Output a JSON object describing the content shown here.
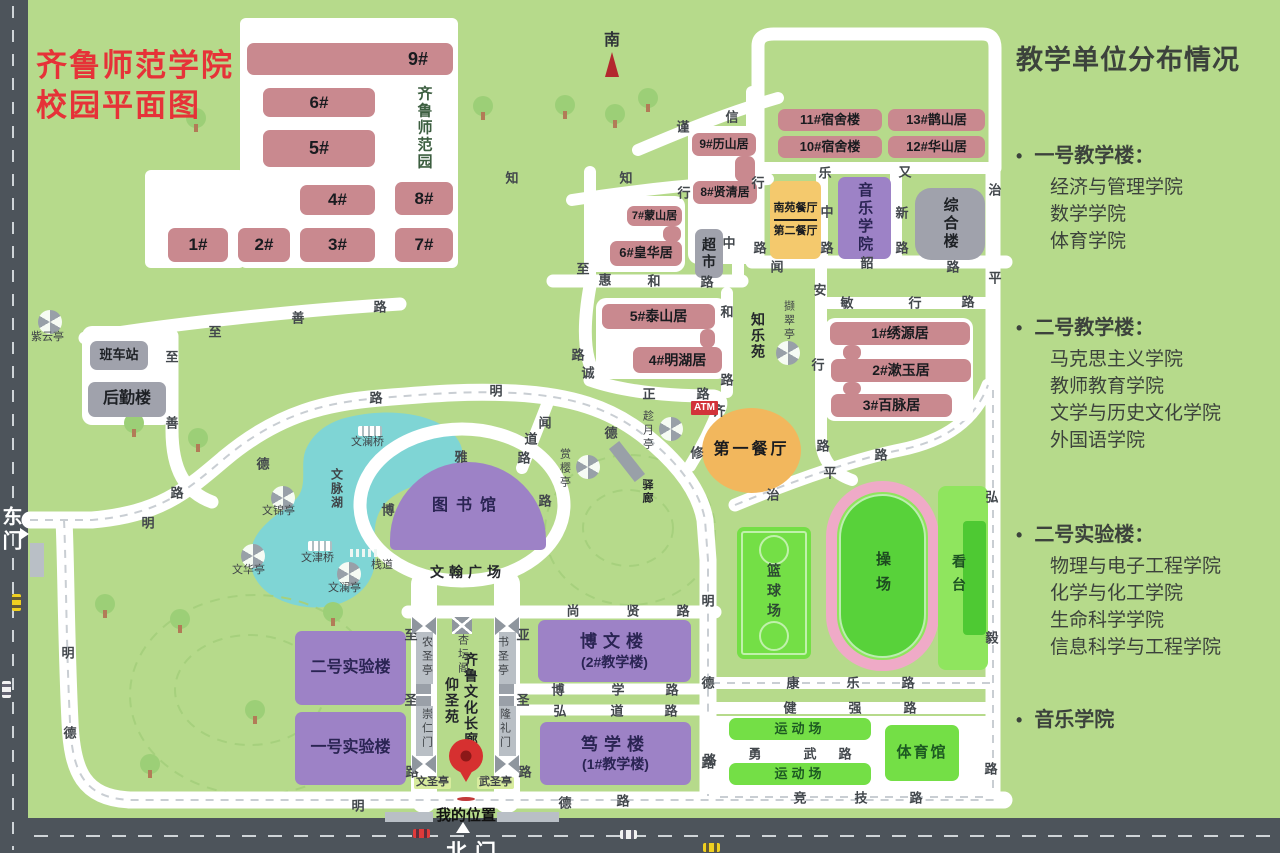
{
  "title": {
    "line1": "齐鲁师范学院",
    "line2": "校园平面图"
  },
  "compass_label": "南",
  "gates": {
    "east": "东门",
    "north": "北门"
  },
  "my_location_label": "我的位置",
  "atm_label": "ATM",
  "sidebar": {
    "title": "教学单位分布情况",
    "sections": [
      {
        "heading": "一号教学楼：",
        "items": [
          "经济与管理学院",
          "数学学院",
          "体育学院"
        ],
        "gap": 0
      },
      {
        "heading": "二号教学楼：",
        "items": [
          "马克思主义学院",
          "教师教育学院",
          "文学与历史文化学院",
          "外国语学院"
        ],
        "gap": 56
      },
      {
        "heading": "二号实验楼：",
        "items": [
          "物理与电子工程学院",
          "化学与化工学院",
          "生命科学学院",
          "信息科学与工程学院"
        ],
        "gap": 64
      },
      {
        "heading": "音乐学院",
        "items": [],
        "gap": 42
      }
    ]
  },
  "plates": [
    {
      "x": 240,
      "y": 18,
      "w": 218,
      "h": 250,
      "r": 6
    },
    {
      "x": 145,
      "y": 170,
      "w": 100,
      "h": 98,
      "r": 6
    },
    {
      "x": 82,
      "y": 326,
      "w": 90,
      "h": 99,
      "r": 10
    },
    {
      "x": 688,
      "y": 126,
      "w": 70,
      "h": 138,
      "r": 10
    },
    {
      "x": 585,
      "y": 196,
      "w": 100,
      "h": 76,
      "r": 10
    },
    {
      "x": 596,
      "y": 298,
      "w": 131,
      "h": 81,
      "r": 10
    },
    {
      "x": 825,
      "y": 318,
      "w": 148,
      "h": 103,
      "r": 10
    },
    {
      "x": 702,
      "y": 716,
      "w": 290,
      "h": 78,
      "r": 6
    }
  ],
  "buildings": [
    {
      "id": "9",
      "label": "9#",
      "type": "pink",
      "x": 247,
      "y": 43,
      "w": 206,
      "h": 32,
      "fs": 18,
      "alignRight": true
    },
    {
      "id": "6",
      "label": "6#",
      "type": "pink",
      "x": 263,
      "y": 88,
      "w": 112,
      "h": 29,
      "fs": 17
    },
    {
      "id": "5",
      "label": "5#",
      "type": "pink",
      "x": 263,
      "y": 130,
      "w": 112,
      "h": 37,
      "fs": 18
    },
    {
      "id": "4",
      "label": "4#",
      "type": "pink",
      "x": 300,
      "y": 185,
      "w": 75,
      "h": 30,
      "fs": 17
    },
    {
      "id": "8",
      "label": "8#",
      "type": "pink",
      "x": 395,
      "y": 182,
      "w": 58,
      "h": 33,
      "fs": 17
    },
    {
      "id": "1",
      "label": "1#",
      "type": "pink",
      "x": 168,
      "y": 228,
      "w": 60,
      "h": 34,
      "fs": 17
    },
    {
      "id": "2",
      "label": "2#",
      "type": "pink",
      "x": 238,
      "y": 228,
      "w": 52,
      "h": 34,
      "fs": 17
    },
    {
      "id": "3",
      "label": "3#",
      "type": "pink",
      "x": 300,
      "y": 228,
      "w": 75,
      "h": 34,
      "fs": 17
    },
    {
      "id": "7",
      "label": "7#",
      "type": "pink",
      "x": 395,
      "y": 228,
      "w": 58,
      "h": 34,
      "fs": 17
    },
    {
      "id": "dorm11",
      "label": "11#宿舍楼",
      "type": "pink",
      "x": 778,
      "y": 109,
      "w": 104,
      "h": 22,
      "fs": 13
    },
    {
      "id": "dorm13",
      "label": "13#鹊山居",
      "type": "pink",
      "x": 888,
      "y": 109,
      "w": 97,
      "h": 22,
      "fs": 13
    },
    {
      "id": "dorm10",
      "label": "10#宿舍楼",
      "type": "pink",
      "x": 778,
      "y": 136,
      "w": 104,
      "h": 22,
      "fs": 13
    },
    {
      "id": "dorm12",
      "label": "12#华山居",
      "type": "pink",
      "x": 888,
      "y": 136,
      "w": 97,
      "h": 22,
      "fs": 13
    },
    {
      "id": "dorm9",
      "label": "9#历山居",
      "type": "pink",
      "x": 692,
      "y": 133,
      "w": 64,
      "h": 23,
      "fs": 12
    },
    {
      "id": "dorm8",
      "label": "8#贤清居",
      "type": "pink",
      "x": 693,
      "y": 181,
      "w": 64,
      "h": 23,
      "fs": 12
    },
    {
      "id": "dorm7",
      "label": "7#蒙山居",
      "type": "pink",
      "x": 627,
      "y": 206,
      "w": 55,
      "h": 20,
      "fs": 11
    },
    {
      "id": "dorm6",
      "label": "6#皇华居",
      "type": "pink",
      "x": 610,
      "y": 241,
      "w": 72,
      "h": 25,
      "fs": 13
    },
    {
      "id": "dorm5",
      "label": "5#泰山居",
      "type": "pink",
      "x": 602,
      "y": 304,
      "w": 113,
      "h": 25,
      "fs": 14
    },
    {
      "id": "dorm4",
      "label": "4#明湖居",
      "type": "pink",
      "x": 633,
      "y": 347,
      "w": 89,
      "h": 26,
      "fs": 14
    },
    {
      "id": "dorm1",
      "label": "1#绣源居",
      "type": "pink",
      "x": 830,
      "y": 322,
      "w": 140,
      "h": 23,
      "fs": 14
    },
    {
      "id": "dorm2",
      "label": "2#漱玉居",
      "type": "pink",
      "x": 831,
      "y": 359,
      "w": 140,
      "h": 23,
      "fs": 14
    },
    {
      "id": "dorm3",
      "label": "3#百脉居",
      "type": "pink",
      "x": 831,
      "y": 394,
      "w": 121,
      "h": 23,
      "fs": 14
    },
    {
      "id": "conn1",
      "label": "",
      "type": "pink",
      "x": 735,
      "y": 156,
      "w": 20,
      "h": 26
    },
    {
      "id": "conn2",
      "label": "",
      "type": "pink",
      "x": 663,
      "y": 226,
      "w": 18,
      "h": 16
    },
    {
      "id": "conn3",
      "label": "",
      "type": "pink",
      "x": 700,
      "y": 329,
      "w": 15,
      "h": 19
    },
    {
      "id": "conn4",
      "label": "",
      "type": "pink",
      "x": 843,
      "y": 345,
      "w": 18,
      "h": 15
    },
    {
      "id": "conn5",
      "label": "",
      "type": "pink",
      "x": 843,
      "y": 382,
      "w": 18,
      "h": 13
    },
    {
      "id": "music",
      "label": "音乐学院",
      "type": "purple",
      "x": 838,
      "y": 177,
      "w": 53,
      "h": 82,
      "fs": 15,
      "vert": true
    },
    {
      "id": "zonghelou",
      "label": "综合楼",
      "type": "grayb",
      "x": 915,
      "y": 188,
      "w": 70,
      "h": 72,
      "fs": 15,
      "vert": true,
      "r": 16
    },
    {
      "id": "bowenlou",
      "label": "博文楼",
      "sub": "(2#教学楼)",
      "type": "purple",
      "x": 538,
      "y": 620,
      "w": 153,
      "h": 62,
      "fs": 17,
      "ls": 6
    },
    {
      "id": "duxuelou",
      "label": "笃学楼",
      "sub": "(1#教学楼)",
      "type": "purple",
      "x": 540,
      "y": 722,
      "w": 151,
      "h": 63,
      "fs": 17,
      "ls": 6
    },
    {
      "id": "lab2",
      "label": "二号实验楼",
      "type": "purple",
      "x": 295,
      "y": 631,
      "w": 111,
      "h": 74,
      "fs": 16
    },
    {
      "id": "lab1",
      "label": "一号实验楼",
      "type": "purple",
      "x": 295,
      "y": 712,
      "w": 111,
      "h": 73,
      "fs": 16
    },
    {
      "id": "library",
      "label": "图书馆",
      "type": "dome",
      "x": 390,
      "y": 462,
      "w": 156,
      "h": 88,
      "fs": 16,
      "ls": 8
    },
    {
      "id": "banchezhan",
      "label": "班车站",
      "type": "grayb",
      "x": 90,
      "y": 341,
      "w": 58,
      "h": 29,
      "fs": 13
    },
    {
      "id": "houqinlou",
      "label": "后勤楼",
      "type": "grayb",
      "x": 88,
      "y": 382,
      "w": 78,
      "h": 35,
      "fs": 16
    },
    {
      "id": "chaoshi",
      "label": "超市",
      "type": "grayb",
      "x": 695,
      "y": 229,
      "w": 28,
      "h": 49,
      "fs": 14,
      "vert": true
    },
    {
      "id": "canteen2",
      "label": "南苑餐厅",
      "sub2": "第二餐厅",
      "type": "split",
      "x": 770,
      "y": 181,
      "w": 51,
      "h": 78,
      "fs": 11
    },
    {
      "id": "canteen1",
      "label": "第一餐厅",
      "type": "orangeb",
      "x": 702,
      "y": 408,
      "w": 99,
      "h": 85,
      "fs": 16,
      "ls": 3
    },
    {
      "id": "basketball",
      "label": "篮球场",
      "type": "court",
      "x": 737,
      "y": 527,
      "w": 74,
      "h": 132,
      "fs": 14
    },
    {
      "id": "playground",
      "label": "操场",
      "type": "track",
      "x": 826,
      "y": 481,
      "w": 113,
      "h": 190
    },
    {
      "id": "stand",
      "label": "看台",
      "type": "stand",
      "x": 938,
      "y": 486,
      "w": 50,
      "h": 184
    },
    {
      "id": "sportsfield1",
      "label": "运动场",
      "type": "bgreen",
      "x": 729,
      "y": 718,
      "w": 142,
      "h": 22,
      "fs": 13,
      "ls": 4
    },
    {
      "id": "sportsfield2",
      "label": "运动场",
      "type": "bgreen",
      "x": 729,
      "y": 763,
      "w": 142,
      "h": 22,
      "fs": 13,
      "ls": 4
    },
    {
      "id": "gym",
      "label": "体育馆",
      "type": "bgreen",
      "x": 885,
      "y": 725,
      "w": 74,
      "h": 56,
      "fs": 15,
      "ls": 2
    }
  ],
  "area_labels": [
    {
      "t": "齐鲁师范园",
      "x": 424,
      "y": 128,
      "vert": true,
      "fs": 15,
      "color": "#3c5e40"
    },
    {
      "t": "知乐苑",
      "x": 758,
      "y": 336,
      "vert": true,
      "fs": 14
    },
    {
      "t": "文脉湖",
      "x": 337,
      "y": 489,
      "vert": true,
      "fs": 12,
      "color": "#3f4347"
    },
    {
      "t": "文翰广场",
      "x": 468,
      "y": 572,
      "vert": false,
      "fs": 14,
      "ls": 5
    },
    {
      "t": "仰圣苑",
      "x": 452,
      "y": 701,
      "vert": true,
      "fs": 14
    },
    {
      "t": "齐鲁文化长廊",
      "x": 471,
      "y": 700,
      "vert": true,
      "fs": 14
    },
    {
      "t": "驿廊",
      "x": 647,
      "y": 492,
      "vert": true,
      "fs": 11
    }
  ],
  "road_labels": [
    [
      "至",
      215,
      331
    ],
    [
      "善",
      298,
      317
    ],
    [
      "路",
      380,
      306
    ],
    [
      "至",
      172,
      356
    ],
    [
      "善",
      172,
      422
    ],
    [
      "路",
      177,
      492
    ],
    [
      "明",
      148,
      522
    ],
    [
      "德",
      263,
      463
    ],
    [
      "路",
      376,
      397
    ],
    [
      "明",
      496,
      390
    ],
    [
      "德",
      611,
      432
    ],
    [
      "诚",
      588,
      372
    ],
    [
      "正",
      649,
      393
    ],
    [
      "路",
      703,
      393
    ],
    [
      "路",
      578,
      354
    ],
    [
      "齐",
      719,
      410
    ],
    [
      "修",
      697,
      452
    ],
    [
      "闻",
      545,
      422
    ],
    [
      "道",
      531,
      438
    ],
    [
      "路",
      524,
      457
    ],
    [
      "博",
      388,
      509
    ],
    [
      "雅",
      461,
      456
    ],
    [
      "路",
      545,
      500
    ],
    [
      "知",
      512,
      177
    ],
    [
      "知",
      626,
      177
    ],
    [
      "行",
      684,
      192
    ],
    [
      "行",
      758,
      182
    ],
    [
      "谨",
      683,
      126
    ],
    [
      "信",
      732,
      116
    ],
    [
      "乐",
      825,
      172
    ],
    [
      "中",
      827,
      211
    ],
    [
      "路",
      827,
      247
    ],
    [
      "又",
      905,
      171
    ],
    [
      "新",
      902,
      212
    ],
    [
      "路",
      902,
      247
    ],
    [
      "治",
      995,
      189
    ],
    [
      "平",
      995,
      277
    ],
    [
      "闻",
      777,
      266
    ],
    [
      "韶",
      867,
      262
    ],
    [
      "路",
      953,
      266
    ],
    [
      "敏",
      847,
      302
    ],
    [
      "行",
      915,
      302
    ],
    [
      "路",
      968,
      301
    ],
    [
      "安",
      820,
      289
    ],
    [
      "行",
      818,
      364
    ],
    [
      "路",
      823,
      445
    ],
    [
      "至",
      583,
      268
    ],
    [
      "惠",
      605,
      279
    ],
    [
      "和",
      654,
      280
    ],
    [
      "路",
      707,
      281
    ],
    [
      "中",
      729,
      242
    ],
    [
      "路",
      760,
      247
    ],
    [
      "和",
      727,
      311
    ],
    [
      "路",
      727,
      379
    ],
    [
      "治",
      773,
      494
    ],
    [
      "平",
      830,
      472
    ],
    [
      "路",
      881,
      454
    ],
    [
      "弘",
      992,
      496
    ],
    [
      "毅",
      992,
      637
    ],
    [
      "路",
      991,
      768
    ],
    [
      "明",
      708,
      600
    ],
    [
      "德",
      708,
      682
    ],
    [
      "路",
      710,
      759
    ],
    [
      "尚",
      573,
      610
    ],
    [
      "贤",
      633,
      610
    ],
    [
      "路",
      683,
      610
    ],
    [
      "博",
      558,
      689
    ],
    [
      "学",
      618,
      689
    ],
    [
      "路",
      672,
      689
    ],
    [
      "弘",
      560,
      710
    ],
    [
      "道",
      617,
      710
    ],
    [
      "路",
      671,
      710
    ],
    [
      "至",
      411,
      634
    ],
    [
      "圣",
      411,
      699
    ],
    [
      "路",
      412,
      771
    ],
    [
      "亚",
      523,
      634
    ],
    [
      "圣",
      523,
      699
    ],
    [
      "路",
      525,
      771
    ],
    [
      "康",
      793,
      682
    ],
    [
      "乐",
      853,
      682
    ],
    [
      "路",
      908,
      682
    ],
    [
      "健",
      790,
      707
    ],
    [
      "强",
      855,
      707
    ],
    [
      "路",
      910,
      707
    ],
    [
      "勇",
      755,
      753
    ],
    [
      "武",
      810,
      753
    ],
    [
      "路",
      845,
      753
    ],
    [
      "竞",
      800,
      797
    ],
    [
      "技",
      861,
      797
    ],
    [
      "路",
      916,
      797
    ],
    [
      "明",
      358,
      805
    ],
    [
      "德",
      565,
      802
    ],
    [
      "路",
      623,
      800
    ],
    [
      "路",
      708,
      762
    ],
    [
      "明",
      68,
      652
    ],
    [
      "德",
      70,
      732
    ]
  ],
  "pois": [
    {
      "label": "紫云亭",
      "type": "pavilion",
      "ix": 38,
      "iy": 310,
      "lx": 31,
      "ly": 332,
      "vert": false
    },
    {
      "label": "文锦亭",
      "type": "pavilion",
      "ix": 271,
      "iy": 486,
      "lx": 262,
      "ly": 506,
      "vert": false
    },
    {
      "label": "文华亭",
      "type": "pavilion",
      "ix": 241,
      "iy": 544,
      "lx": 232,
      "ly": 565,
      "vert": false
    },
    {
      "label": "文澜亭",
      "type": "pavilion",
      "ix": 337,
      "iy": 562,
      "lx": 328,
      "ly": 583,
      "vert": false
    },
    {
      "label": "撷翠亭",
      "type": "pavilion",
      "ix": 776,
      "iy": 341,
      "lx": 782,
      "ly": 300,
      "vert": true
    },
    {
      "label": "趁月亭",
      "type": "pavilion",
      "ix": 659,
      "iy": 417,
      "lx": 641,
      "ly": 410,
      "vert": true
    },
    {
      "label": "赏樱亭",
      "type": "pavilion",
      "ix": 576,
      "iy": 455,
      "lx": 558,
      "ly": 448,
      "vert": true
    },
    {
      "label": "文澜桥",
      "type": "bridge",
      "ix": 358,
      "iy": 426,
      "lx": 351,
      "ly": 437,
      "vert": false
    },
    {
      "label": "文津桥",
      "type": "bridge",
      "ix": 308,
      "iy": 541,
      "lx": 301,
      "ly": 553,
      "vert": false
    },
    {
      "label": "栈道",
      "type": "boardwalk",
      "ix": 350,
      "iy": 549,
      "lx": 371,
      "ly": 560,
      "vert": false
    },
    {
      "label": "驿廊",
      "type": "slab",
      "ix": 606,
      "iy": 455,
      "lx": -100,
      "ly": -100,
      "vert": false
    },
    {
      "label": "农圣亭",
      "type": "bowtie",
      "ix": 412,
      "iy": 617,
      "lx": 420,
      "ly": 636,
      "vert": true
    },
    {
      "label": "杏坛阁",
      "type": "xbox",
      "ix": 452,
      "iy": 617,
      "lx": 456,
      "ly": 634,
      "vert": true
    },
    {
      "label": "书圣亭",
      "type": "bowtie",
      "ix": 495,
      "iy": 617,
      "lx": 496,
      "ly": 636,
      "vert": true
    },
    {
      "label": "崇仁门",
      "type": "gaterect",
      "ix": 416,
      "iy": 684,
      "lx": 420,
      "ly": 708,
      "vert": true
    },
    {
      "label": "隆礼门",
      "type": "gaterect",
      "ix": 499,
      "iy": 684,
      "lx": 498,
      "ly": 708,
      "vert": true
    },
    {
      "label": "",
      "type": "bowtie",
      "ix": 412,
      "iy": 755,
      "lx": -100,
      "ly": -100,
      "vert": false
    },
    {
      "label": "",
      "type": "bowtie",
      "ix": 495,
      "iy": 755,
      "lx": -100,
      "ly": -100,
      "vert": false
    },
    {
      "label": "文圣亭",
      "type": "hlabel",
      "ix": -100,
      "iy": -100,
      "lx": 414,
      "ly": 777,
      "vert": false
    },
    {
      "label": "武圣亭",
      "type": "hlabel",
      "ix": -100,
      "iy": -100,
      "lx": 477,
      "ly": 777,
      "vert": false
    }
  ],
  "vehicles": [
    {
      "c": "#e03a3a",
      "x": 413,
      "y": 829,
      "vert": false
    },
    {
      "c": "#f2f2f2",
      "x": 620,
      "y": 830,
      "vert": false
    },
    {
      "c": "#f0d020",
      "x": 703,
      "y": 843,
      "vert": false
    },
    {
      "c": "#f0d020",
      "x": 12,
      "y": 594,
      "vert": true
    },
    {
      "c": "#f2f2f2",
      "x": 2,
      "y": 681,
      "vert": true
    }
  ],
  "patches": [
    {
      "x": 385,
      "y": 812,
      "w": 48,
      "h": 10
    },
    {
      "x": 497,
      "y": 812,
      "w": 62,
      "h": 10
    },
    {
      "x": 30,
      "y": 543,
      "w": 14,
      "h": 34
    }
  ],
  "trees": [
    [
      186,
      108
    ],
    [
      473,
      96
    ],
    [
      605,
      104
    ],
    [
      638,
      88
    ],
    [
      104,
      386
    ],
    [
      124,
      413
    ],
    [
      188,
      428
    ],
    [
      95,
      594
    ],
    [
      170,
      609
    ],
    [
      300,
      645
    ],
    [
      245,
      700
    ],
    [
      140,
      754
    ],
    [
      323,
      602
    ],
    [
      555,
      95
    ]
  ]
}
